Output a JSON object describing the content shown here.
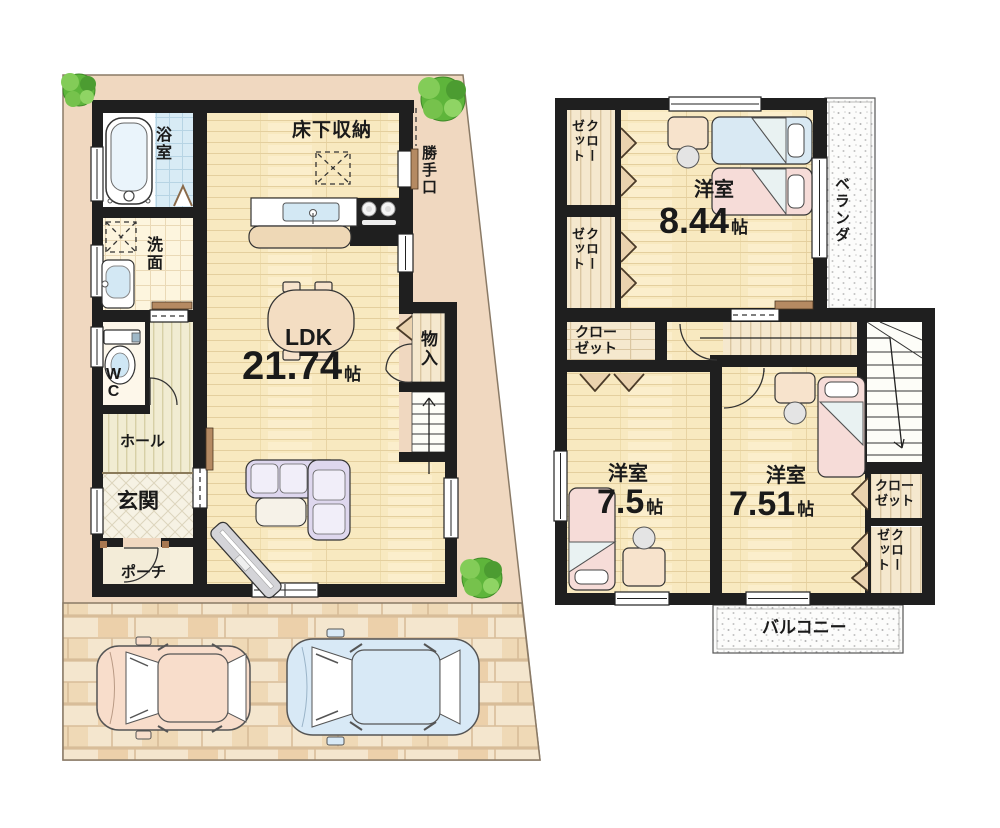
{
  "floor1": {
    "underfloor_storage": "床下収納",
    "back_door": "勝手口",
    "bath": "浴室",
    "washroom": "洗面",
    "wc": "WC",
    "hall": "ホール",
    "entrance": "玄関",
    "porch": "ポーチ",
    "ldk_name": "LDK",
    "ldk_size": "21.74",
    "size_unit": "帖",
    "storage": "物入"
  },
  "floor2": {
    "bedroom_name": "洋室",
    "bedroom1_size": "8.44",
    "bedroom2_size": "7.5",
    "bedroom3_size": "7.51",
    "size_unit": "帖",
    "closet_line1": "クロー",
    "closet_line2": "ゼット",
    "veranda": "ベランダ",
    "balcony": "バルコニー"
  },
  "colors": {
    "wall": "#1f1f1f",
    "site": "#f0d8c0",
    "wood": "#f8e9c0",
    "tile": "#d8ebf5",
    "stipple_bg": "#fcfcfb",
    "tree": "#5eb53b",
    "car_pink": "#f8ddcb",
    "car_blue": "#d8e9f6"
  }
}
